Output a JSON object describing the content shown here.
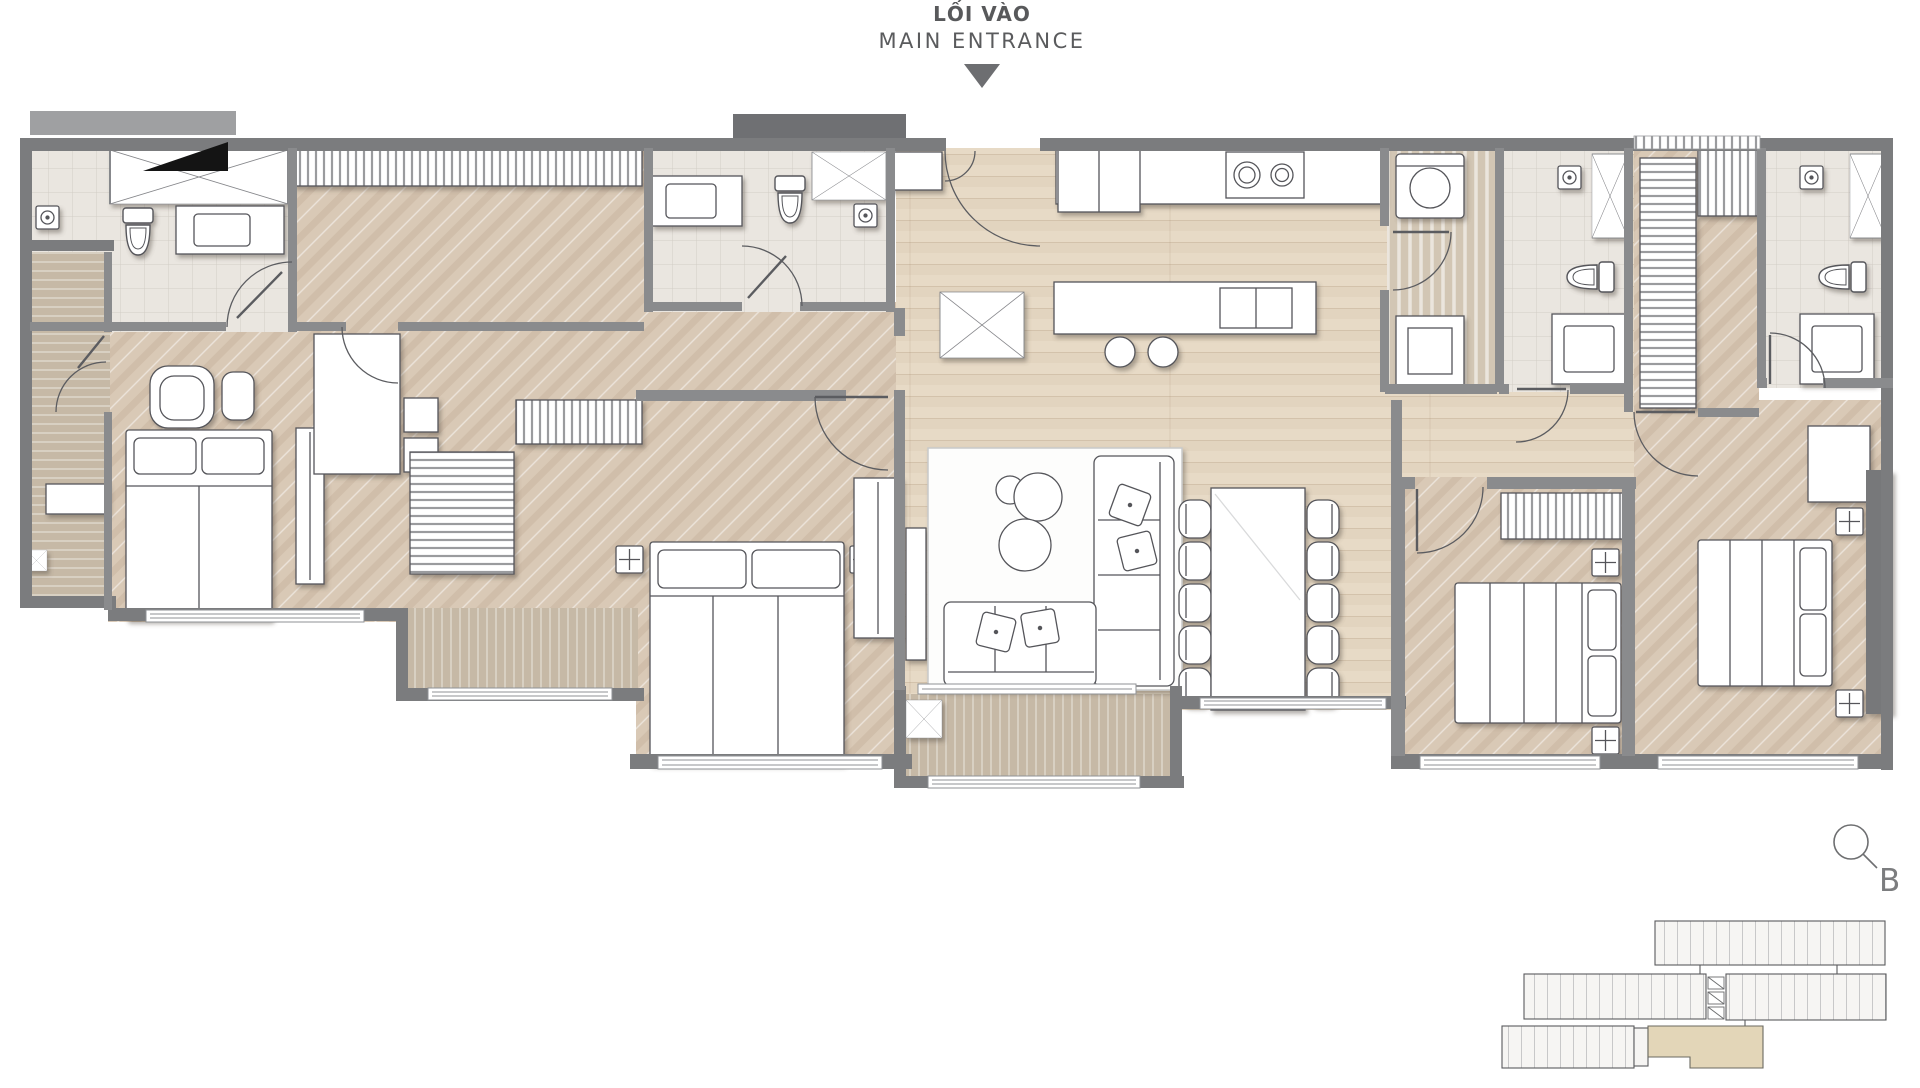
{
  "header": {
    "title_vi": "LỐI VÀO",
    "title_en": "MAIN ENTRANCE"
  },
  "key_plan": {
    "block_label": "B"
  },
  "colors": {
    "text": "#58595b",
    "arrow": "#6d6e71",
    "wall": "#7b7c7e",
    "wall_light": "#8a8b8d",
    "wall_dark": "#6f7073",
    "wood_plank": "#e7dac6",
    "wood_herringbone": "#d9c9b6",
    "deck": "#c6b9a6",
    "tile": "#eae6e0",
    "utility_floor": "#d2c6b4",
    "line": "#54555a",
    "keyplan_highlight": "#e3d6b8"
  }
}
